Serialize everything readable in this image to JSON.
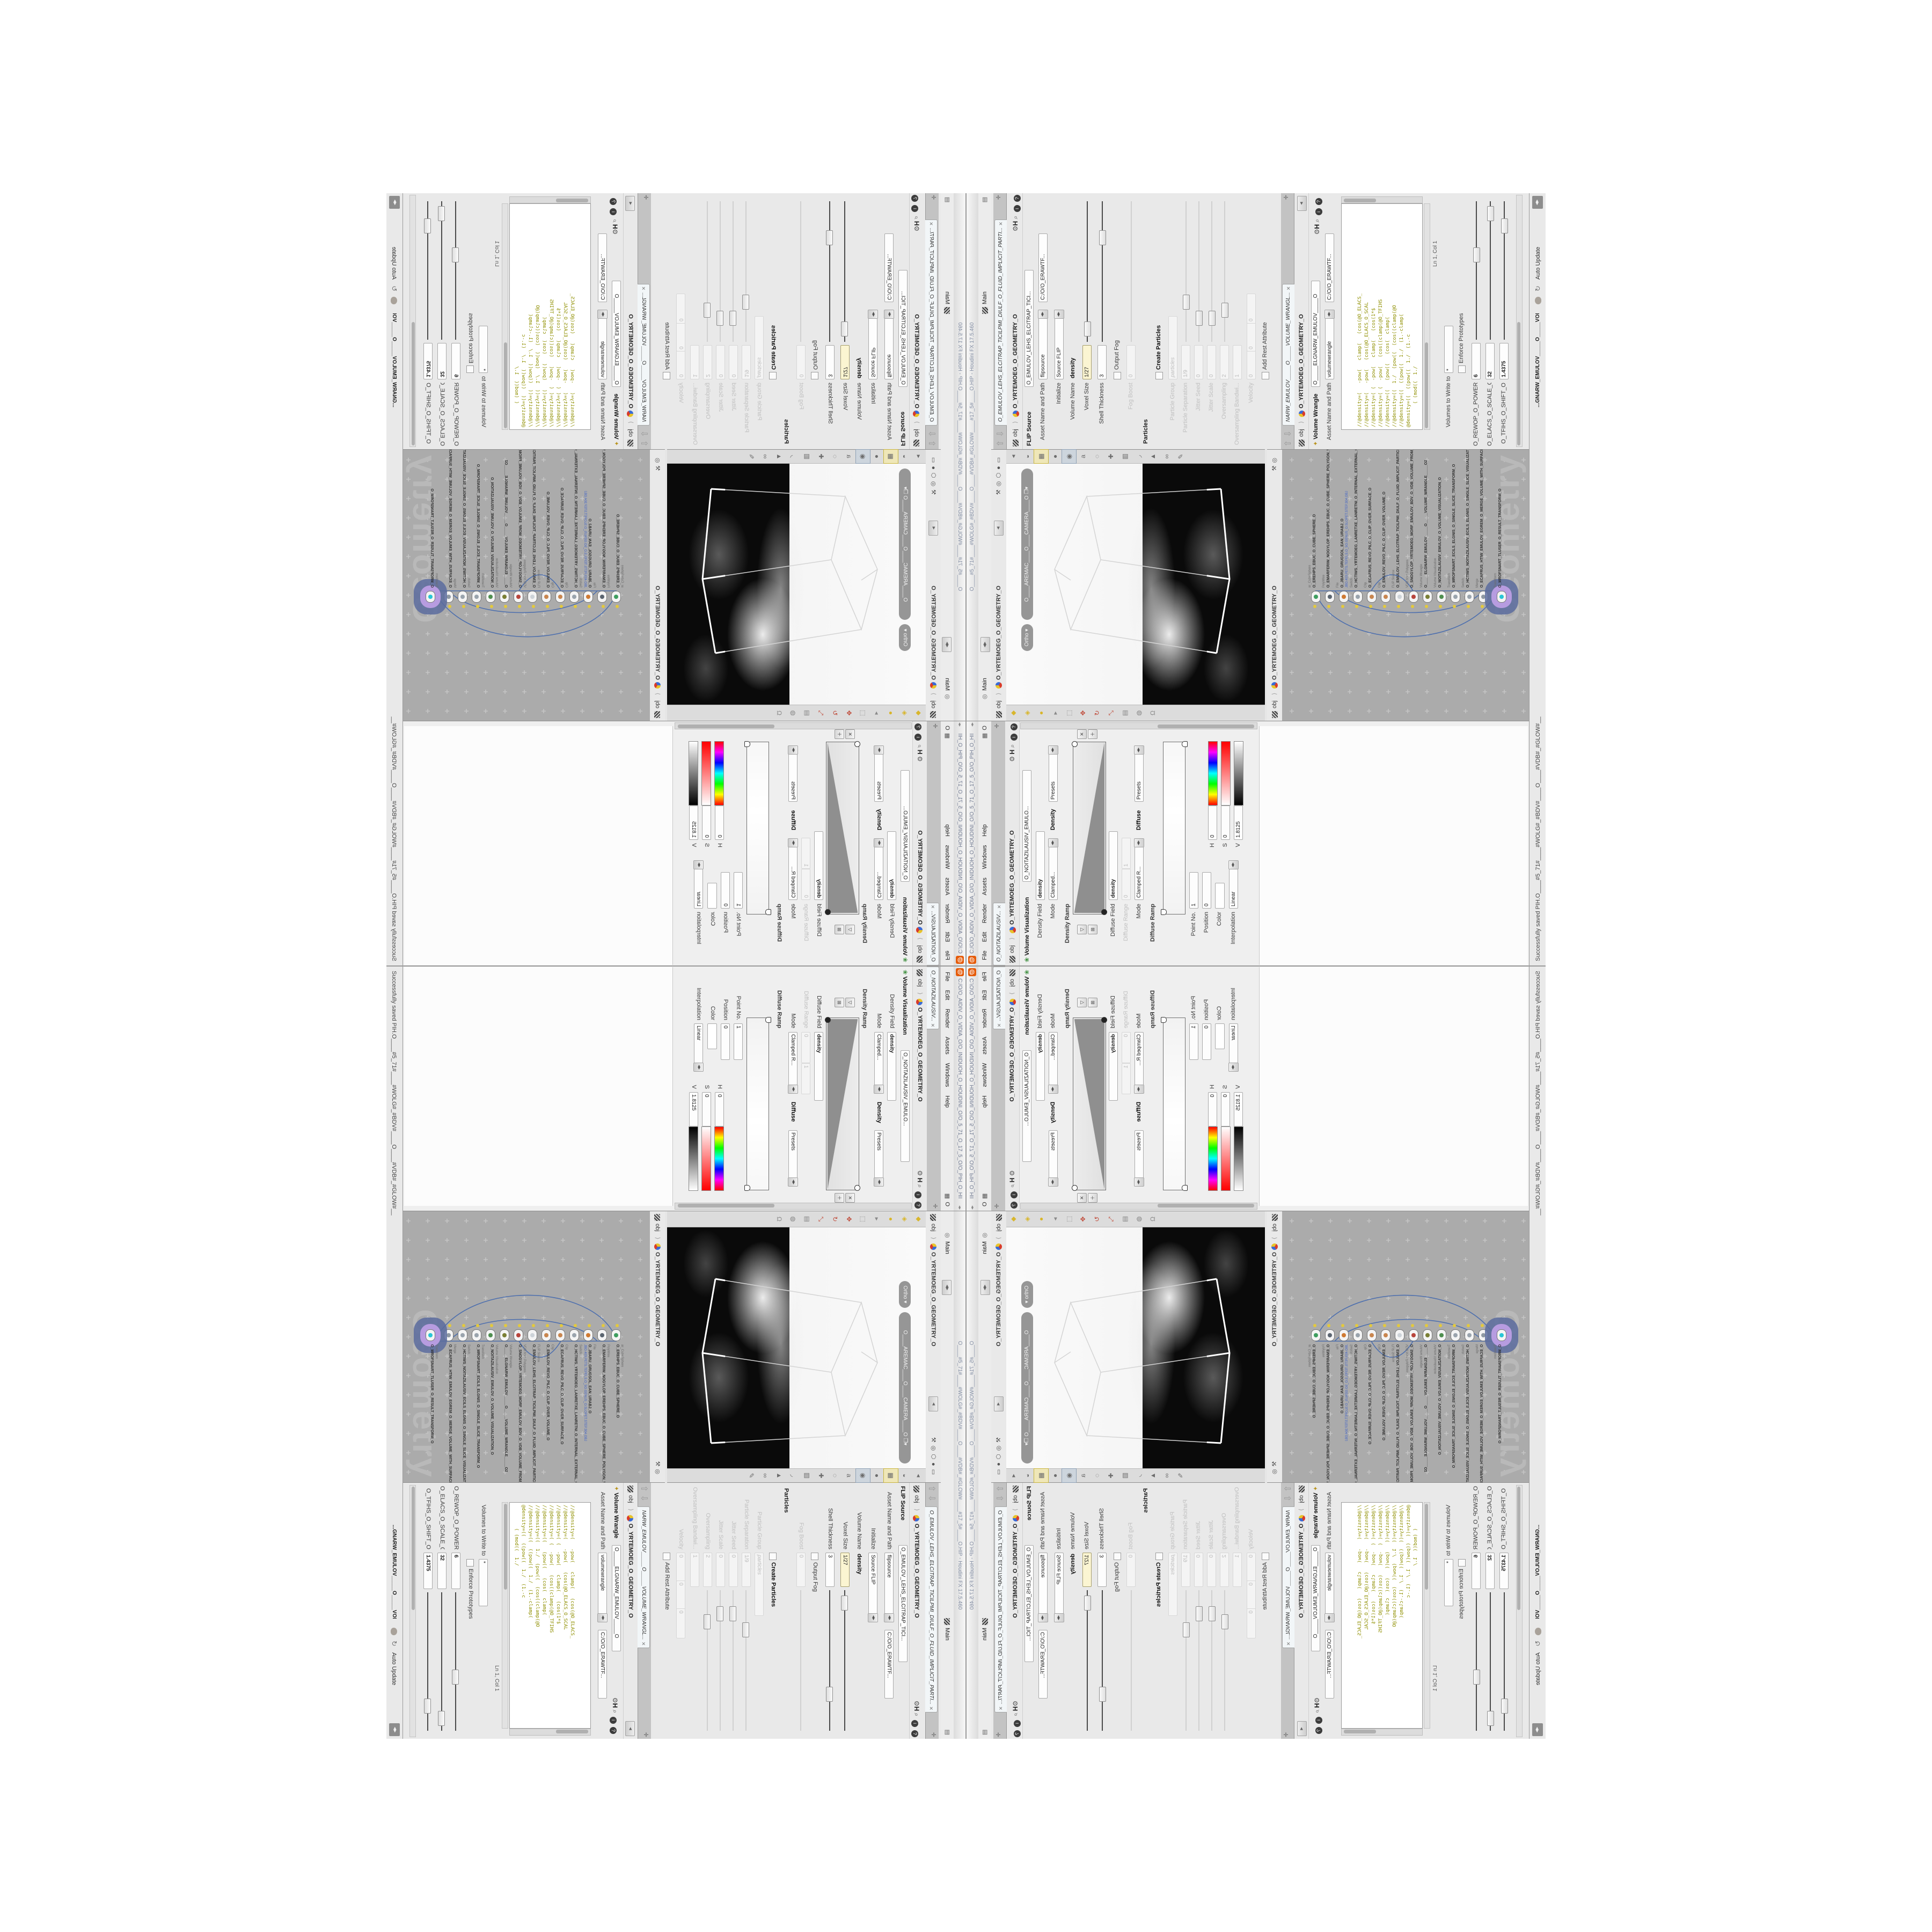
{
  "float_window": {
    "title": "C:/O/O_AIDIV_O_VIDIA_O/O_INIDUOH_O_HOUDINI_O/O_5_71_O_17_5_O/O_PIH_O_HIP_O/PIH.O__",
    "menu_items": [
      "File",
      "Edit",
      "Render",
      "Assets",
      "Windows",
      "Help"
    ],
    "menu_right_label": "O",
    "tabs": [
      {
        "label": "O____ARTNAM_..."
      },
      {
        "label": "O____AREMAC_..."
      },
      {
        "label": "O_NOITAZILAUSIV...",
        "cls": "active"
      }
    ],
    "breadcrumb_root": "obj",
    "breadcrumb_node": "O_YRTEMOEG_O_GEOMETRY_O",
    "pane_node_label": "Volume Visualization",
    "pane_node_name": "O_NOITAZILAUSIV_EMULO...",
    "density_field_label": "Density Field",
    "density_field_value": "density",
    "mode_label": "Mode",
    "mode_value": "Clamped...",
    "density_section": "Density",
    "presets_label": "Presets",
    "density_ramp_label": "Density Ramp",
    "diffuse_field_label": "Diffuse Field",
    "diffuse_field_value": "density",
    "diffuse_range_label": "Diffuse Range",
    "diffuse_range_min": "0",
    "diffuse_range_max": "1",
    "mode2_value": "Clamped R...",
    "diffuse_section": "Diffuse",
    "diffuse_ramp_label": "Diffuse Ramp",
    "point_no_label": "Point No.",
    "point_no_value": "1",
    "position_label": "Position",
    "position_value": "0",
    "color_label": "Color",
    "interp_label": "Interpolation",
    "interp_value": "Linear",
    "h_label": "H",
    "h_value": "0",
    "s_label": "S",
    "s_value": "0",
    "v_label": "V",
    "v_value": "1.8125"
  },
  "main_window": {
    "title": "O____#5_71#____#WOLG#_#BDV#____O____#VDB#_#GLOW#____#17_5#____O.HIP  -  Houdini FX 17.5.460",
    "desktop_left_label": "Main",
    "desktop_right_label": "Main"
  },
  "viewport": {
    "breadcrumb_root": "obj",
    "breadcrumb_node": "O_YRTEMOEG_O_GEOMETRY_O",
    "ortho_pill": "Ortho",
    "camera_pill": "O____AREMAC____O____CAMERA____O",
    "left_tools": [
      {
        "g": "◆",
        "color": "#d8b62c"
      },
      {
        "g": "◈",
        "color": "#d8b62c"
      },
      {
        "g": "●",
        "color": "#d8b62c"
      },
      {
        "g": "▸",
        "color": "#8a8a8a"
      },
      {
        "g": "⬚",
        "color": "#8a8a8a"
      },
      {
        "g": "✥",
        "color": "#c04b3a"
      },
      {
        "g": "↻",
        "color": "#c04b3a"
      },
      {
        "g": "⤡",
        "color": "#c04b3a"
      },
      {
        "g": "▤",
        "color": "#8a8a8a"
      },
      {
        "g": "◍",
        "color": "#8a8a8a"
      },
      {
        "g": "Ω",
        "color": "#8a8a8a"
      }
    ],
    "right_tools": [
      {
        "g": "◂"
      },
      {
        "g": "◒"
      },
      {
        "g": "▦",
        "cls": "hl"
      },
      {
        "g": "●"
      },
      {
        "g": "◉",
        "cls": "pressed"
      },
      {
        "g": "a"
      },
      {
        "g": "◌"
      },
      {
        "g": "✚"
      },
      {
        "g": "▥"
      },
      {
        "g": "◞"
      },
      {
        "g": "▲"
      },
      {
        "g": "∞"
      },
      {
        "g": "✎"
      }
    ]
  },
  "network": {
    "breadcrumb_root": "obj",
    "breadcrumb_node": "O_YRTEMOEG_O_GEOMETRY_O",
    "watermark": "Geometry",
    "nodes": [
      {
        "type": "ar_CubeSphere",
        "name": "O_EREHPS_EBUC_O_CUBE_SPHERE_O",
        "color": "#3f9e5f"
      },
      {
        "type": "PolyWire",
        "name": "O_EMARFERIW_NOGYLOP_EREHPS_EBUC_O_CUBE_SPHERE_POLYGON_WIREFRAME_O",
        "color": "#5b6570"
      },
      {
        "type": "File",
        "name": "O_JBARU_GRUGSOL_EAN_URABJ_O",
        "sub": "JBO.403.PETS.TEPELS.O_5O.GENUS_O.SLOPET.STEP.304.OBJ",
        "color": "#cf7a33"
      },
      {
        "type": "Switch",
        "name": "O_HCTIWS_YRTEMOEG_LANRETXE_LANRETNI_O_INTERNAL_EXTERNAL_GEOMETRY_SWITCH_O",
        "color": "#9aa4ad"
      },
      {
        "type": "Clip",
        "name": "O_ECAFRUS_REVO_PILC_O_CLIP_OVER_SURFACE_O",
        "color": "#c8864f"
      },
      {
        "type": "Clip",
        "name": "O_EMULOV_REVO_PILC_O_CLIP_OVER_VOLUME_O",
        "color": "#c8864f"
      },
      {
        "type": "FLIP Source",
        "name": "O_EMULOV_LEHS_ELCITRAP_TICILPMI_DIULF_O_FLUID_IMPLICIT_PARTICLE_SHELL_VOLUME_O",
        "color": "#cdd3d8"
      },
      {
        "type": "VDB from Polygons",
        "name": "O_SNOGYLOP_YRTEMOEG_MORF_EMULOV_BDV_O_VDB_VOLUME_FROM_GEOMETRY_POLYGONS_O",
        "color": "#b8453c"
      },
      {
        "type": "Volume Wrangle",
        "name": "O_____ELGNARW_EMULOV_____O_____VOLUME_WRANGLE_____O2",
        "color": "#7a7f35"
      },
      {
        "type": "Volume Visualization",
        "name": "O_NOITAZILAUSIV_EMULOV_O_VOLUME_VISUALIZATION_O",
        "color": "#4f8f4f"
      },
      {
        "type": "Transform",
        "name": "O_MROFSNART_ECILS_ELGNIS_O_SINGLE_SLICE_TRANSFORM_O",
        "color": "#9aa4ad"
      },
      {
        "type": "Switch",
        "name": "O_HCTIWS_NOITAZILAUSIV_ECILS_ELGNIS_O_SINGLE_SLICE_VISUALIZATION_SWITCH_O",
        "color": "#9aa4ad"
      },
      {
        "type": "Merge",
        "name": "O_ECAFRUS_HTIW_EMULOV_EGREM_O_MERGE_VOLUME_WITH_SURFACE_O",
        "color": "#8f99a3"
      },
      {
        "type": "Transform",
        "name": "O_MROFSNART_TLUSER_O_RESULT_TRANSFORM_O",
        "color": "#29c5d6",
        "cls": "sel"
      }
    ]
  },
  "flip_pane": {
    "tab": "O_EMULOV_LEHS_ELCITRAP_TICILPMI_DIULF_O_FLUID_IMPLICIT_PARTI...",
    "breadcrumb_root": "obj",
    "breadcrumb_node": "O_YRTEMOEG_O_GEOMETRY_O",
    "node_label": "FLIP Source",
    "node_name": "O_EMULOV_LEHS_ELCITRAP_TICI...",
    "path_label": "Asset Name and Path",
    "path_value": "flipsource",
    "path_value2": "C:/O/O_ERAWTF...",
    "initialize_label": "Initialize",
    "initialize_value": "Source FLIP",
    "volume_name_label": "Volume Name",
    "volume_name_value": "density",
    "voxel_size_label": "Voxel Size",
    "voxel_size_value": "1/27",
    "shell_thickness_label": "Shell Thickness",
    "shell_thickness_value": "3",
    "output_fog_label": "Output Fog",
    "fog_boost_label": "Fog Boost",
    "fog_boost_value": "0",
    "particles_section": "Particles",
    "create_particles_label": "Create Particles",
    "particle_group_label": "Particle Group",
    "particle_group_value": "particles",
    "particle_separation_label": "Particle Separation",
    "particle_separation_value": "1/9",
    "jitter_seed_label": "Jitter Seed",
    "jitter_seed_value": "0",
    "jitter_scale_label": "Jitter Scale",
    "jitter_scale_value": "0",
    "oversampling_label": "Oversampling",
    "oversampling_value": "2",
    "oversampling_bw_label": "Oversampling Bandwi...",
    "oversampling_bw_value": "1",
    "velocity_label": "Velocity",
    "velocity_x": "0",
    "velocity_y": "0",
    "velocity_z": "0",
    "add_rest_label": "Add Rest Attribute"
  },
  "wrangle_pane": {
    "tab": "NARW_EMULOV_____O_____VOLUME_WRANGL...",
    "breadcrumb_root": "obj",
    "breadcrumb_node": "O_YRTEMOEG_O_GEOMETRY_O",
    "node_label": "Volume Wrangle",
    "node_name": "O_____ELGNARW_EMULOV_____O",
    "path_label": "Asset Name and Path",
    "path_value": "volumewrangle",
    "path_value2": "C:/O/O_ERAWTF...",
    "code_lines": [
      "//@density=(   -pow(   clamp(   (cos(@O_ELACS_",
      "//@density=(   -pow(   (cos(@O_ELACS_O_SCAL",
      "//@density=( (  -pow(   clamp(   (cos(1*$",
      "//@density=( (  -pow(   (cos((clamp(@O_TFIHS",
      "//@density=((   (pow((   (cos(  clamp(",
      "//@density=((  1./  (pow((  (cos((clamp(@O",
      "//@density=((  ((pow((  1./  (1.-clamp(",
      "@density=((  ((pow((  1./  (1.-c",
      "        ( (mod((  1./"
    ],
    "ln_col": "Ln 1, Col 1",
    "volumes_label": "Volumes to Write to",
    "volumes_value": "*",
    "enforce_label": "Enforce Prototypes",
    "params": [
      {
        "label": "O_REWOP_O_POWER...",
        "value": "6",
        "pct": 0.65
      },
      {
        "label": "O_ELACS_O_SCALE_O",
        "value": "32",
        "pct": 0.95
      },
      {
        "label": "O_TFIHS_O_SHIFT_O",
        "value": "1.4375",
        "pct": 0.86
      }
    ]
  },
  "status_bar": {
    "message": "Successfully saved PIH.O____#5_71#____#WOLG#_#BDV#____O____#VDB#_#GLOW#__",
    "node_path": "...GNARW_EMULOV_____O_____VOLUME_WRANGL...",
    "auto_update_label": "Auto Update"
  },
  "colors": {
    "houdini_orange": "#e55b0a",
    "wire_blue": "#4d6fae",
    "selection_purple": "#b79ce0",
    "selection_ring": "#5a6b9e",
    "code_olive": "#8f8f00",
    "highlight_cream": "#fbf5d2",
    "network_bg": "#ababab",
    "viewport_black": "#0a0a0a"
  }
}
